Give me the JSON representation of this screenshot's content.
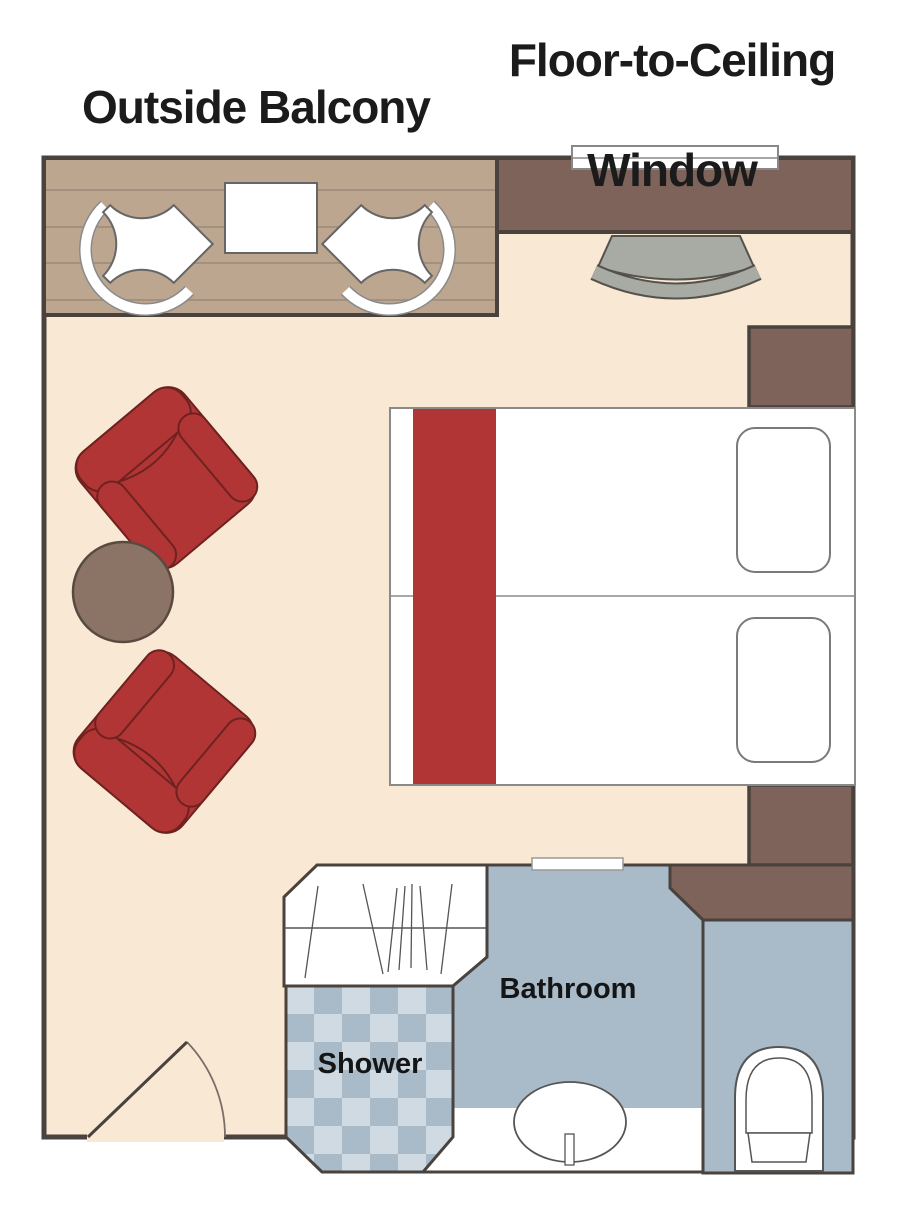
{
  "titles": {
    "outside_balcony": "Outside Balcony",
    "window_line1": "Floor-to-Ceiling",
    "window_line2": "Window"
  },
  "room_labels": {
    "bathroom": "Bathroom",
    "shower": "Shower"
  },
  "furniture": {
    "balcony_items": "two balcony chairs, balcony table",
    "room_items": "two red armchairs, round side table, twin beds with pillows, desk, desk chair, two nightstands, wardrobe, entry door",
    "bath_items": "shower, sink with faucet, toilet, bathroom door threshold"
  },
  "colors": {
    "floor": "#f9e8d4",
    "balcony_deck": "#bca68f",
    "balcony_plank_line": "#a3907f",
    "wood_brown": "#7d635a",
    "wall_outline": "#4a423c",
    "armchair_red": "#b23535",
    "armchair_outline": "#6e2220",
    "side_table_brown": "#8b7365",
    "bed_white": "#ffffff",
    "bed_runner_red": "#b23535",
    "desk_chair_gray": "#a8aba3",
    "bathroom_blue": "#a9bac8",
    "checker_light": "#cfdae3",
    "checker_dark": "#a9bac8",
    "fixture_white": "#ffffff",
    "label_text": "#151515"
  }
}
